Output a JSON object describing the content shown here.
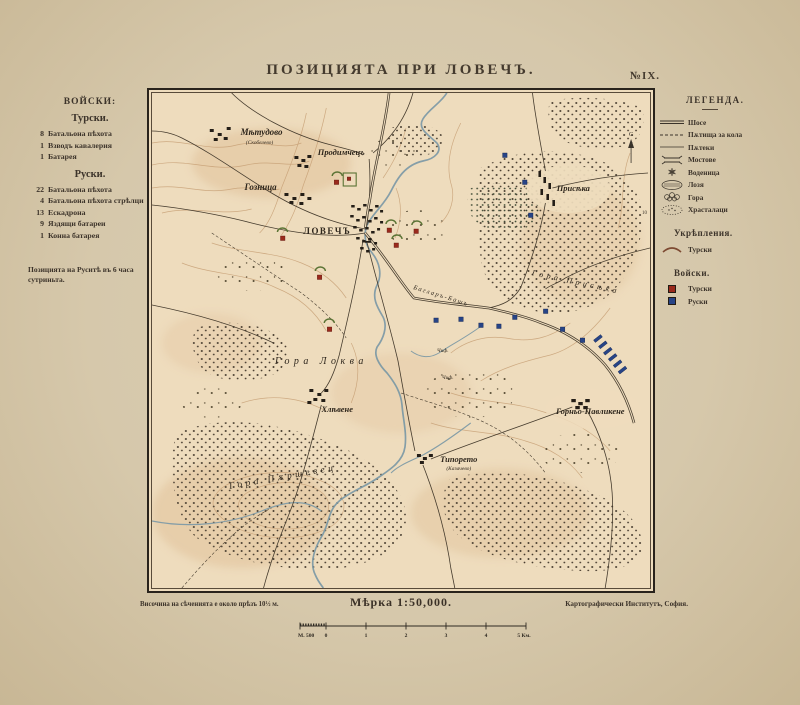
{
  "page": {
    "title": "ПОЗИЦИЯТА ПРИ ЛОВЕЧЪ.",
    "sheet_no": "№IX."
  },
  "left_panel": {
    "heading": "ВОЙСКИ:",
    "turkish": {
      "heading": "Турски.",
      "items": [
        {
          "num": "8",
          "label": "Батальона пѣхота"
        },
        {
          "num": "1",
          "label": "Взводъ кавалерия"
        },
        {
          "num": "1",
          "label": "Батарея"
        }
      ]
    },
    "russian": {
      "heading": "Руски.",
      "items": [
        {
          "num": "22",
          "label": "Батальона пѣхота"
        },
        {
          "num": "4",
          "label": "Батальона пѣхота стрѣлци"
        },
        {
          "num": "13",
          "label": "Ескадрона"
        },
        {
          "num": "9",
          "label": "Яздящи батареи"
        },
        {
          "num": "1",
          "label": "Конна батарея"
        }
      ]
    },
    "note": "Позицията на Руситѣ въ 6 часа сутриньта."
  },
  "legend": {
    "heading": "ЛЕГЕНДА.",
    "items": [
      {
        "icon": "chaussee-line",
        "label": "Шосе"
      },
      {
        "icon": "cart-road-line",
        "label": "Пѫтища за кола"
      },
      {
        "icon": "footpath-line",
        "label": "Пѫтеки"
      },
      {
        "icon": "bridge",
        "label": "Мостове"
      },
      {
        "icon": "watermill",
        "label": "Воденица"
      },
      {
        "icon": "vineyard",
        "label": "Лозя"
      },
      {
        "icon": "forest",
        "label": "Гора"
      },
      {
        "icon": "shrubs",
        "label": "Храсталаци"
      }
    ],
    "fortifications": {
      "heading": "Укрѣпления.",
      "items": [
        {
          "icon": "redoubt-arc",
          "label": "Турски"
        }
      ]
    },
    "troops": {
      "heading": "Войски.",
      "items": [
        {
          "icon": "square",
          "label": "Турски",
          "color": "#9a2a1c"
        },
        {
          "icon": "square",
          "label": "Руски",
          "color": "#274487"
        }
      ]
    }
  },
  "map": {
    "compass": "С",
    "spot_height": "10",
    "labels": [
      {
        "text": "Мѣтудово"
      },
      {
        "text": "(Скобелево)"
      },
      {
        "text": "Продимчецъ"
      },
      {
        "text": "Гозница"
      },
      {
        "text": "ЛОВЕЧЪ"
      },
      {
        "text": "Присѣка"
      },
      {
        "text": "Гора Присѣка"
      },
      {
        "text": "Багларъ-Башъ"
      },
      {
        "text": "Гора Локва"
      },
      {
        "text": "Хлѣвене"
      },
      {
        "text": "Чиф."
      },
      {
        "text": "Чиф."
      },
      {
        "text": "Типорето"
      },
      {
        "text": "(Казачево)"
      },
      {
        "text": "Горньо-Павликене"
      },
      {
        "text": "Гора Пѫршевец"
      }
    ]
  },
  "footer": {
    "note": "Височина на сѣченията е около прѣзъ 10½ м.",
    "scale": "Мѣрка 1:50,000.",
    "publisher": "Картографически Институтъ, София.",
    "scalebar": [
      "М. 500",
      "0",
      "1",
      "2",
      "3",
      "4",
      "5 Км."
    ]
  },
  "colors": {
    "turkish": "#9a2a1c",
    "russian": "#274487",
    "fortification": "#5a7334",
    "river": "#7e9aa6",
    "contour": "#c49a6e",
    "paper": "#d8caae",
    "map_bg": "#eedcbd"
  }
}
